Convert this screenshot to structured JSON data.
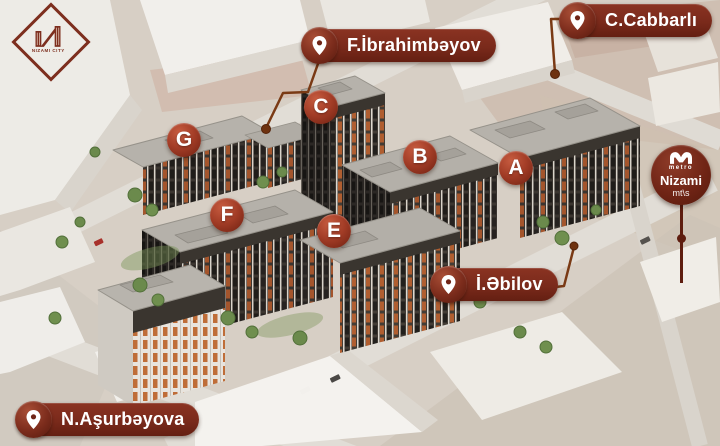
{
  "logo": {
    "name": "NIZAMI CITY"
  },
  "street_labels": [
    {
      "id": "f-ibrahimbeyov",
      "label": "F.İbrahimbəyov"
    },
    {
      "id": "c-cabbarli",
      "label": "C.Cabbarlı"
    },
    {
      "id": "i-abilov",
      "label": "İ.Əbilov"
    },
    {
      "id": "n-ashurbeyova",
      "label": "N.Aşurbəyova"
    }
  ],
  "building_badges": [
    {
      "letter": "G"
    },
    {
      "letter": "C"
    },
    {
      "letter": "B"
    },
    {
      "letter": "A"
    },
    {
      "letter": "F"
    },
    {
      "letter": "E"
    }
  ],
  "metro": {
    "word": "metro",
    "station": "Nizami",
    "suffix": "mt\\s"
  },
  "colors": {
    "pill_maroon": "#7a2a1b",
    "badge_red": "#a23c26",
    "connector_brown": "#7a3a15",
    "facade_dark": "#3b3530",
    "window_orange": "#b05e30",
    "roof_gray": "#b5b1aa"
  }
}
